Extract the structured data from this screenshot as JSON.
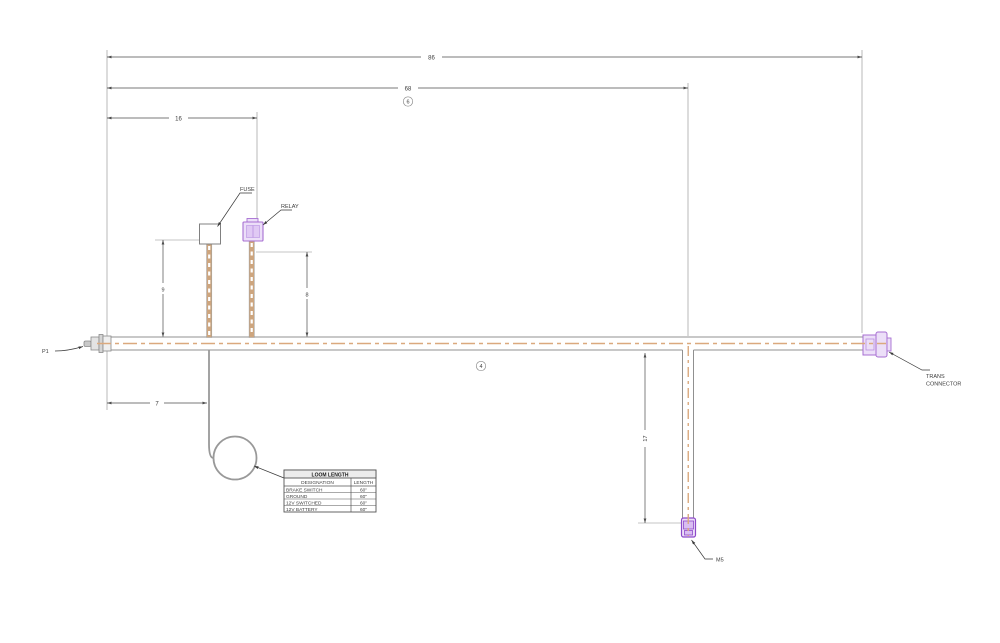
{
  "title": "Wiring loom engineering drawing",
  "colors": {
    "accent_purple": "#a76fd2",
    "purple_fill": "#ecdff8",
    "wire_tan": "#cda57e",
    "centerline_tan": "#dba97e",
    "outline_gray": "#909090",
    "dimension_gray": "#4d4d4d"
  },
  "dimensions": {
    "overall_length": "86",
    "length_to_drop": "68",
    "length_to_relay": "16",
    "fuse_lead_height": "9",
    "relay_lead_height": "8",
    "loop_offset": "7",
    "drop_length": "17"
  },
  "balloons": {
    "top": "6",
    "middle": "4"
  },
  "labels": {
    "fuse": "FUSE",
    "relay": "RELAY",
    "left_connector": "P1",
    "trans_connector_line1": "TRANS",
    "trans_connector_line2": "CONNECTOR",
    "drop_connector": "M5"
  },
  "loom_table": {
    "title": "LOOM LENGTH",
    "headers": {
      "designation": "DESIGNATION",
      "length": "LENGTH"
    },
    "rows": [
      {
        "designation": "BRAKE SWITCH",
        "length": "60\""
      },
      {
        "designation": "GROUND",
        "length": "60\""
      },
      {
        "designation": "12V SWITCHED",
        "length": "60\""
      },
      {
        "designation": "12V BATTERY",
        "length": "60\""
      }
    ]
  }
}
